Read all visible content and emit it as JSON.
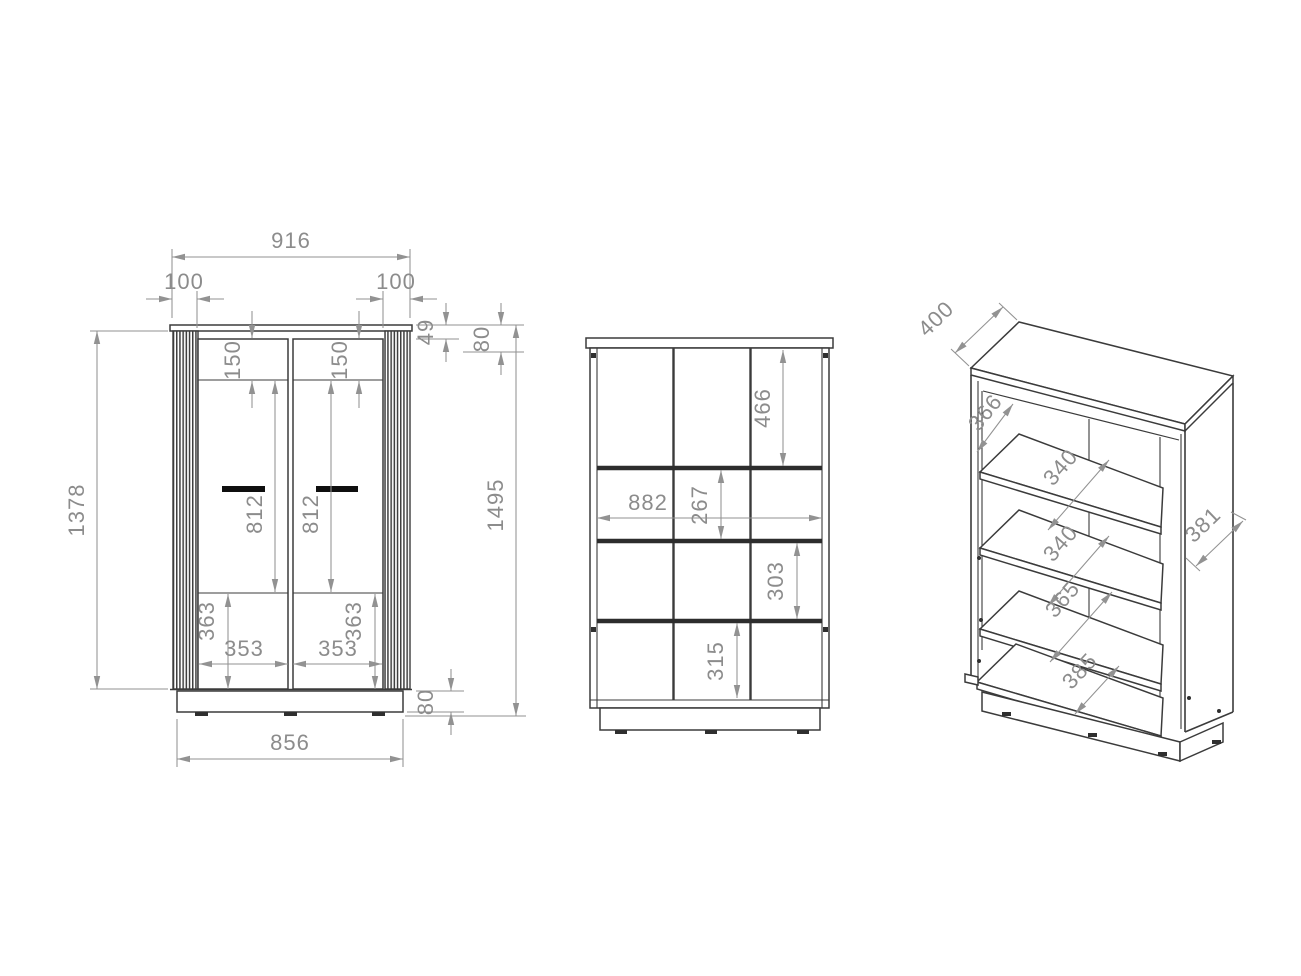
{
  "drawing": {
    "front_view": {
      "overall_width": "916",
      "side_panel_left": "100",
      "side_panel_right": "100",
      "top_board": "49",
      "top_section": "80",
      "door_top_left": "150",
      "door_top_right": "150",
      "body_height": "1378",
      "total_height": "1495",
      "door_height_left": "812",
      "door_height_right": "812",
      "bottom_section_left": "363",
      "bottom_section_right": "363",
      "door_width_left": "353",
      "door_width_right": "353",
      "plinth_height": "80",
      "base_width": "856"
    },
    "open_view": {
      "top_compartment": "466",
      "interior_width": "882",
      "compartment_2": "267",
      "compartment_3": "303",
      "compartment_4": "315"
    },
    "iso_view": {
      "top_depth": "400",
      "gap_top": "366",
      "gap_a": "340",
      "gap_b": "340",
      "side_depth": "381",
      "gap_c": "365",
      "gap_bottom": "385"
    },
    "colors": {
      "edge_dark": "#3b3b3b",
      "dimension_gray": "#8c8c8c",
      "handle_black": "#0f0f0f",
      "background": "#ffffff"
    }
  }
}
